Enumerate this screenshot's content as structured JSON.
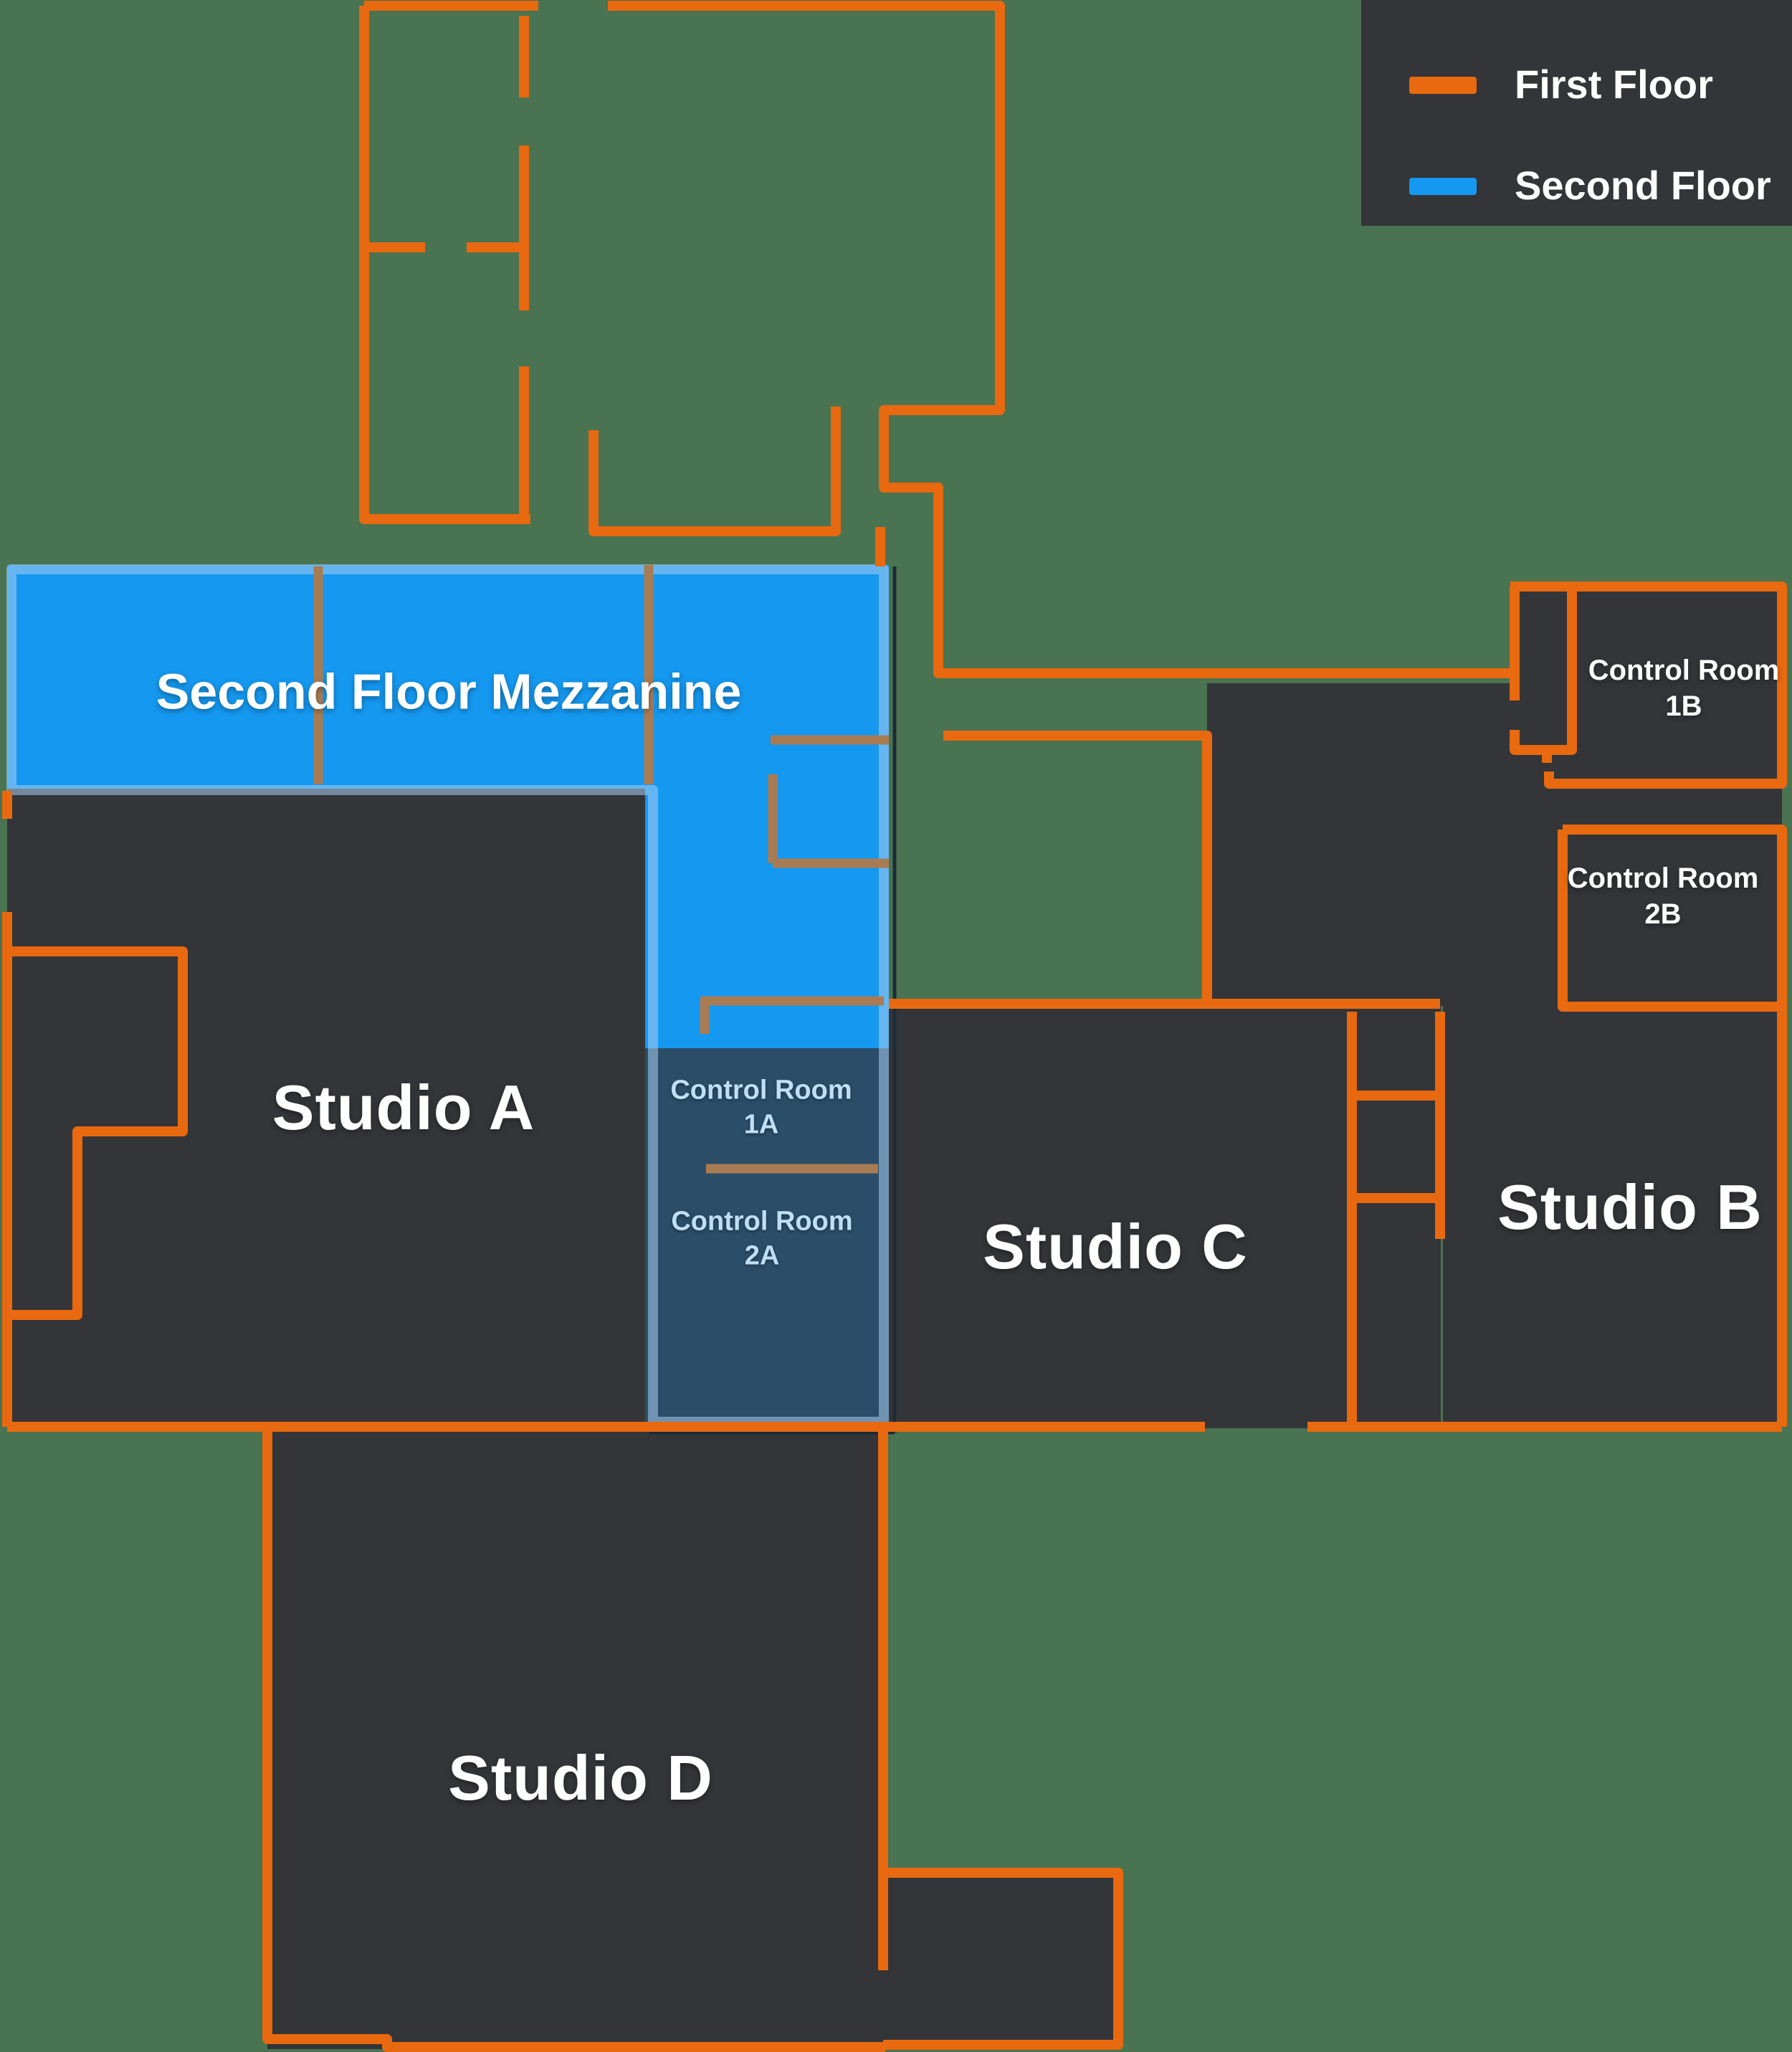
{
  "title": "Studio facility floor plan",
  "legend": {
    "items": [
      {
        "id": "first-floor",
        "label": "First Floor",
        "color": "#E8690F"
      },
      {
        "id": "second-floor",
        "label": "Second Floor",
        "color": "#1598F0"
      }
    ]
  },
  "rooms": {
    "mezzanine": {
      "label": "Second Floor Mezzanine"
    },
    "studio_a": {
      "label": "Studio A"
    },
    "studio_b": {
      "label": "Studio B"
    },
    "studio_c": {
      "label": "Studio C"
    },
    "studio_d": {
      "label": "Studio D"
    },
    "control_1a": {
      "label": "Control Room 1A"
    },
    "control_2a": {
      "label": "Control Room 2A"
    },
    "control_1b": {
      "label": "Control Room 1B"
    },
    "control_2b": {
      "label": "Control Room 2B"
    }
  },
  "colors": {
    "background_green": "#4A7351",
    "room_dark": "#333538",
    "first_floor_orange": "#E8690F",
    "second_floor_blue": "#1598F0",
    "mezzanine_border": "#9CC2E4",
    "control_panel_navy": "#2B4D68",
    "interior_wall_tan": "#A97B52",
    "control_a_text": "#BFDFF7",
    "label_white": "#FFFFFF"
  }
}
